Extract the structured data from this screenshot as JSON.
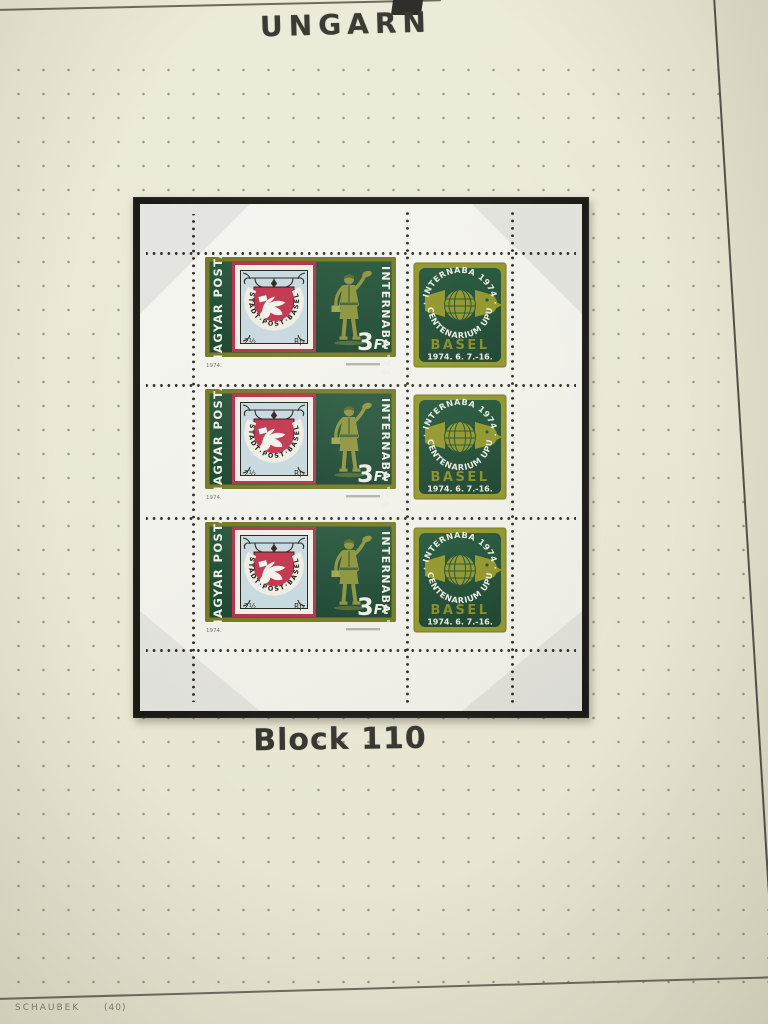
{
  "page": {
    "title": "UNGARN",
    "caption": "Block 110"
  },
  "footer": {
    "publisher": "SCHAUBEK",
    "sheet_number": "(40)"
  },
  "block": {
    "rows": 3,
    "stamp": {
      "country": "MAGYAR POSTA",
      "event": "INTERNABA '74",
      "denomination": "3",
      "currency": "Ft",
      "imprint_year": "1974.",
      "basel_dove": {
        "ribbon": "STADT·POST·BASEL",
        "value": "2½",
        "value_currency": "Rp"
      }
    },
    "label": {
      "arc_top": "· INTERNABA 1974 ·",
      "arc_bottom": "CENTENARIUM UPU",
      "city": "BASEL",
      "dates": "1974. 6. 7.-16."
    }
  },
  "colors": {
    "album_page": "#eae8d5",
    "mount_black": "#191813",
    "sheet_white": "#f1f1ea",
    "stamp_olive": "#72761f",
    "label_olive": "#8f9325",
    "stamp_green": "#1b4830",
    "shield_red": "#c02f48",
    "basel_blue": "#c6d8de",
    "text_white": "#edefe3"
  }
}
